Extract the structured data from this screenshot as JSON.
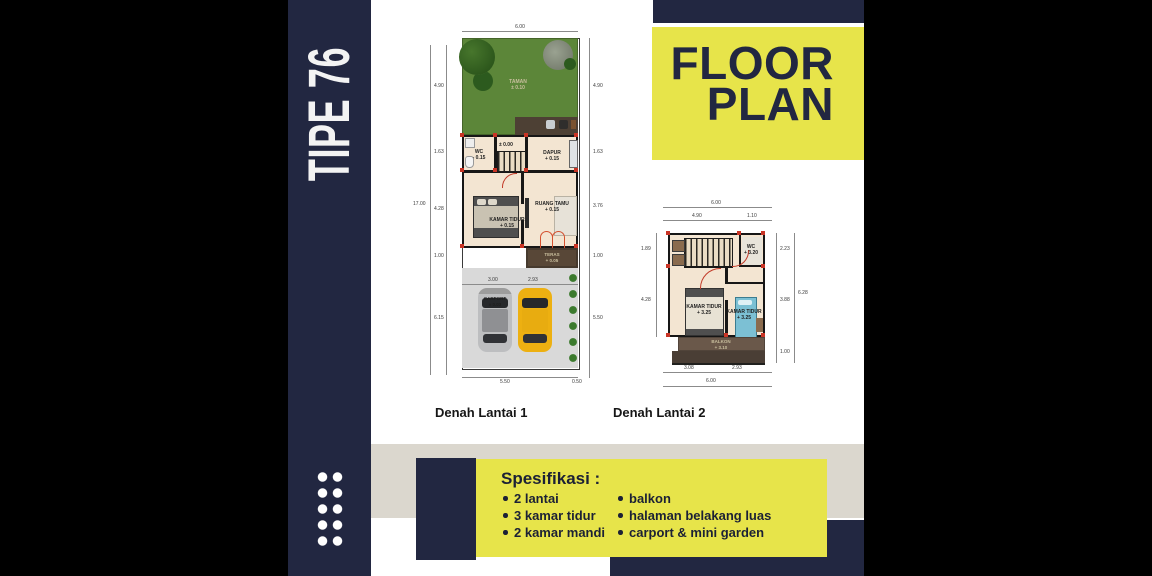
{
  "colors": {
    "navy": "#222741",
    "yellow": "#e7e44a",
    "beige": "#dbd7ce",
    "background": "#000000",
    "floor": "#f3e5d2",
    "garden_green": "#5c8639"
  },
  "left_banner": {
    "title": "TIPE 76"
  },
  "header": {
    "line1": "FLOOR",
    "line2": "PLAN"
  },
  "plan1": {
    "caption": "Denah Lantai 1",
    "labels": {
      "garden": {
        "name": "TAMAN",
        "level": "± 0.10"
      },
      "wc": {
        "name": "WC",
        "level": "- 0.15"
      },
      "stairs": {
        "level": "± 0.00"
      },
      "dapur": {
        "name": "DAPUR",
        "level": "+ 0.15"
      },
      "kamar_tidur": {
        "name": "KAMAR TIDUR",
        "level": "+ 0.15"
      },
      "ruang_tamu": {
        "name": "RUANG TAMU",
        "level": "+ 0.15"
      },
      "teras": {
        "name": "TERAS",
        "level": "+ 0.05"
      },
      "carport": {
        "name": "CARPORT",
        "level": "± 0.03"
      }
    },
    "dims": {
      "top": "6.00",
      "left_total": "17.00",
      "left": [
        "4.90",
        "1.63",
        "4.28",
        "1.00",
        "6.15"
      ],
      "right": [
        "4.90",
        "1.63",
        "3.76",
        "1.00",
        "5.50"
      ],
      "carport": [
        "3.00",
        "2.93"
      ],
      "bottom": [
        "5.50",
        "0.50"
      ]
    }
  },
  "plan2": {
    "caption": "Denah Lantai 2",
    "labels": {
      "wc": {
        "name": "WC",
        "level": "+ 3.20"
      },
      "kamar_tidur_1": {
        "name": "KAMAR TIDUR",
        "level": "+ 3.25"
      },
      "kamar_tidur_2": {
        "name": "KAMAR TIDUR",
        "level": "+ 3.25"
      },
      "balkon": {
        "name": "BALKON",
        "level": "+ 3.10"
      }
    },
    "dims": {
      "top": "6.00",
      "top_split": [
        "4.90",
        "1.10"
      ],
      "left": [
        "1.89",
        "4.28"
      ],
      "right": [
        "2.23",
        "3.88",
        "1.00"
      ],
      "right_total": "6.28",
      "bottom_split": [
        "3.08",
        "2.93"
      ],
      "bottom": "6.00"
    }
  },
  "spec": {
    "heading": "Spesifikasi :",
    "col1": [
      "2 lantai",
      "3 kamar tidur",
      "2 kamar mandi"
    ],
    "col2": [
      "balkon",
      "halaman belakang luas",
      "carport & mini garden"
    ]
  }
}
